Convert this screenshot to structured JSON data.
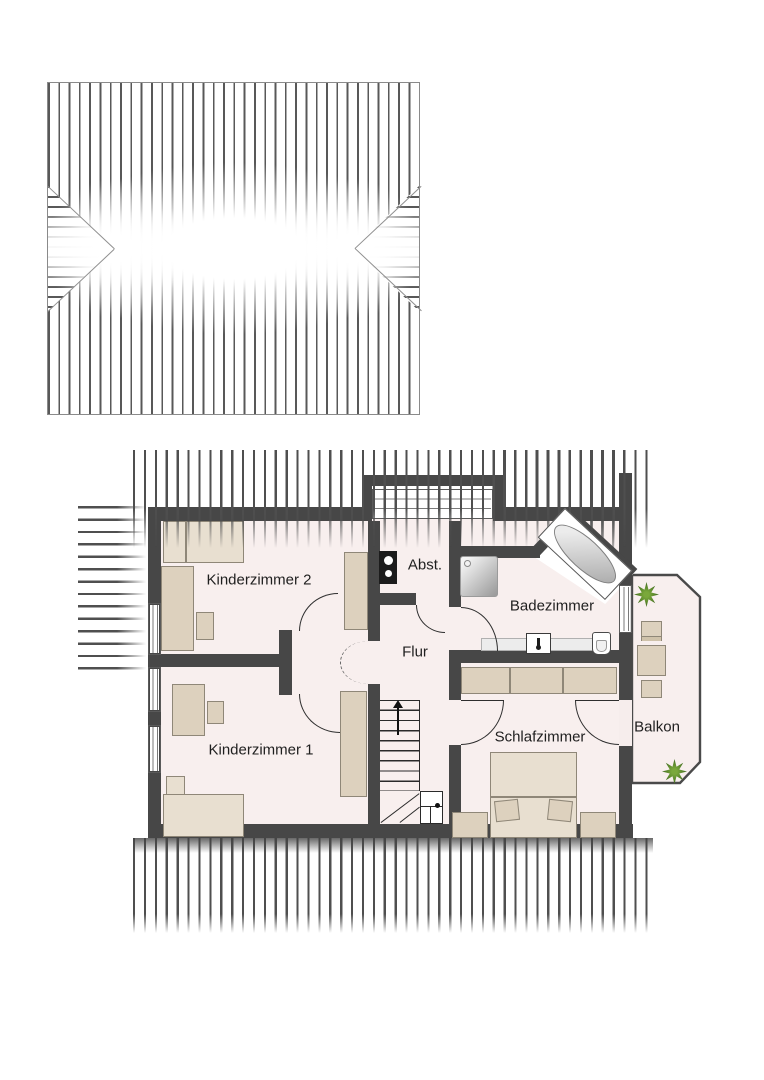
{
  "figure": "upper-floor-plan-with-roof-plan",
  "rooms": {
    "kinderzimmer2": {
      "label": "Kinderzimmer 2",
      "furniture": [
        "bed",
        "desk",
        "chair",
        "wardrobe"
      ]
    },
    "kinderzimmer1": {
      "label": "Kinderzimmer 1",
      "furniture": [
        "bed",
        "desk",
        "chair",
        "wardrobe"
      ]
    },
    "flur": {
      "label": "Flur",
      "furniture": [
        "staircase-up"
      ]
    },
    "abstellraum": {
      "label": "Abst.",
      "furniture": [
        "water-heater"
      ]
    },
    "badezimmer": {
      "label": "Badezimmer",
      "furniture": [
        "shower",
        "corner-bathtub",
        "washbasin",
        "toilet"
      ]
    },
    "schlafzimmer": {
      "label": "Schlafzimmer",
      "furniture": [
        "double-bed",
        "nightstand",
        "nightstand",
        "wardrobe"
      ]
    },
    "balkon": {
      "label": "Balkon",
      "furniture": [
        "table",
        "chair",
        "chair",
        "plant",
        "plant"
      ]
    }
  },
  "colors": {
    "wall": "#474747",
    "hatch_line": "#4f4f4f",
    "floor": "#f8efee",
    "furniture": "#ddd1be",
    "furniture_border": "#8f8778",
    "plant_green": "#4f7f26",
    "label_text": "#1f1f1f"
  }
}
